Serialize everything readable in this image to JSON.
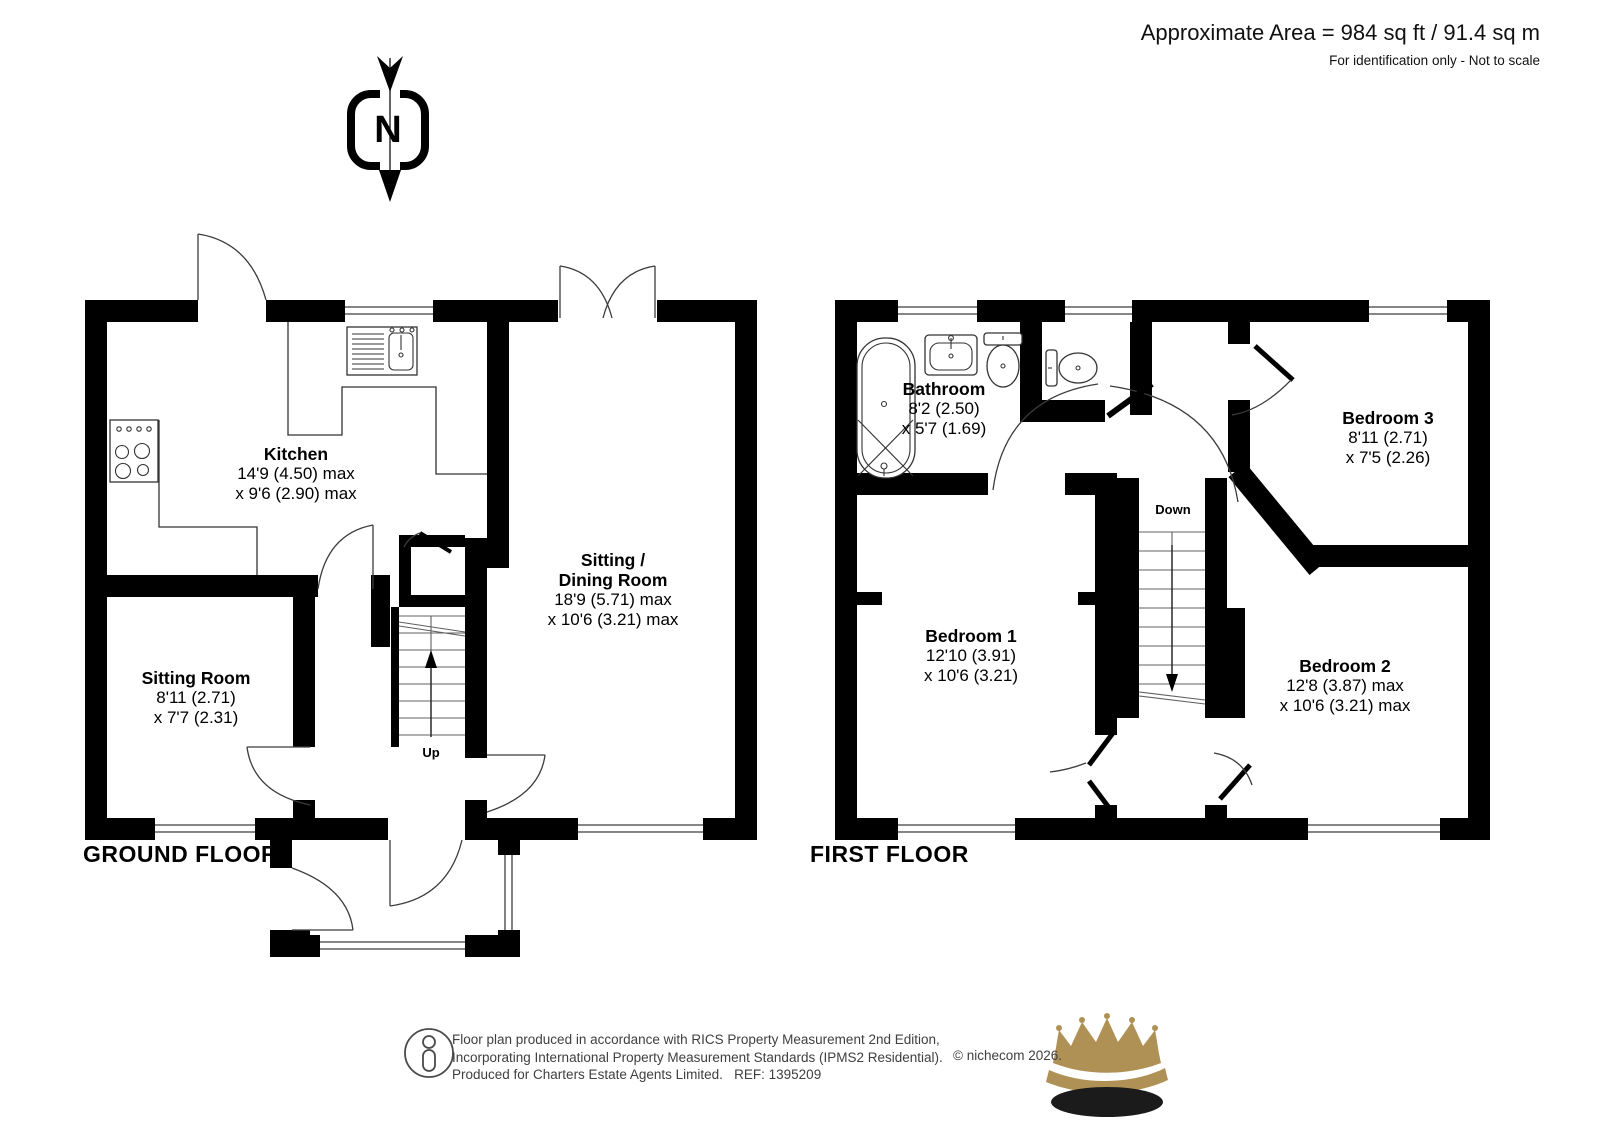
{
  "header": {
    "area_line": "Approximate Area = 984 sq ft / 91.4 sq m",
    "disclaimer": "For identification only - Not to scale"
  },
  "compass": {
    "north_letter": "N"
  },
  "ground_floor": {
    "title": "GROUND FLOOR",
    "stairs_label": "Up",
    "rooms": {
      "kitchen": {
        "name": "Kitchen",
        "dims": [
          "14'9 (4.50) max",
          "x 9'6 (2.90) max"
        ]
      },
      "sitting_room": {
        "name": "Sitting Room",
        "dims": [
          "8'11 (2.71)",
          "x 7'7 (2.31)"
        ]
      },
      "sitting_dining": {
        "name_lines": [
          "Sitting /",
          "Dining Room"
        ],
        "dims": [
          "18'9 (5.71) max",
          "x 10'6 (3.21) max"
        ]
      }
    }
  },
  "first_floor": {
    "title": "FIRST FLOOR",
    "stairs_label": "Down",
    "rooms": {
      "bathroom": {
        "name": "Bathroom",
        "dims": [
          "8'2 (2.50)",
          "x 5'7 (1.69)"
        ]
      },
      "bedroom1": {
        "name": "Bedroom 1",
        "dims": [
          "12'10 (3.91)",
          "x 10'6 (3.21)"
        ]
      },
      "bedroom2": {
        "name": "Bedroom 2",
        "dims": [
          "12'8 (3.87) max",
          "x 10'6 (3.21) max"
        ]
      },
      "bedroom3": {
        "name": "Bedroom 3",
        "dims": [
          "8'11 (2.71)",
          "x 7'5 (2.26)"
        ]
      }
    }
  },
  "footer": {
    "line1": "Floor plan produced in accordance with RICS Property Measurement 2nd Edition,",
    "line2": "Incorporating International Property Measurement Standards (IPMS2 Residential).",
    "copyright": "© nichecom 2026.",
    "line3": "Produced for Charters Estate Agents Limited.   REF: 1395209"
  },
  "colors": {
    "wall": "#000000",
    "crown_gold": "#af9155",
    "crown_base": "#1b1b1b"
  }
}
